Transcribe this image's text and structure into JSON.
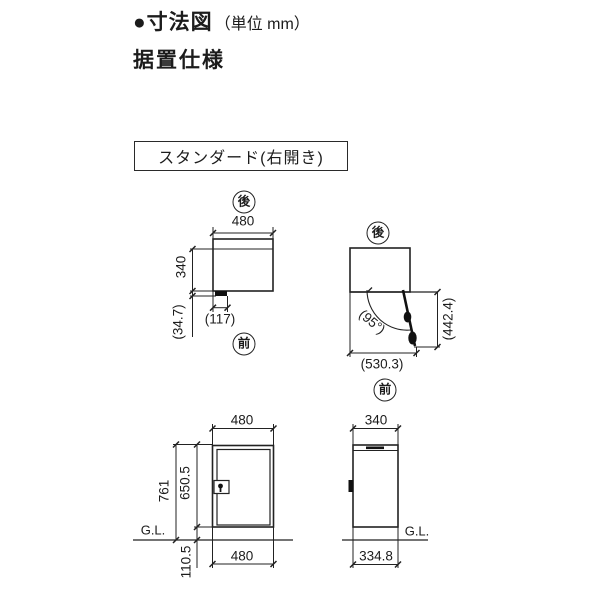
{
  "header": {
    "title": "●寸法図",
    "unit_note": "（単位 mm）",
    "subtitle": "据置仕様",
    "variant": "スタンダード(右開き)"
  },
  "plan_view": {
    "back": "後",
    "front": "前",
    "width": "480",
    "depth": "340",
    "lock_protrusion": "(34.7)",
    "lock_width": "(117)"
  },
  "door_swing_view": {
    "back": "後",
    "front": "前",
    "open_angle": "(95°)",
    "open_depth": "(530.3)",
    "open_side": "(442.4)"
  },
  "front_view": {
    "width_top": "480",
    "total_height": "761",
    "body_height": "650.5",
    "base_height": "110.5",
    "ground": "G.L.",
    "width_bottom": "480"
  },
  "side_view": {
    "depth_top": "340",
    "ground": "G.L.",
    "base_depth": "334.8"
  },
  "colors": {
    "line": "#222222",
    "text": "#1c1c1c",
    "background": "#ffffff"
  }
}
